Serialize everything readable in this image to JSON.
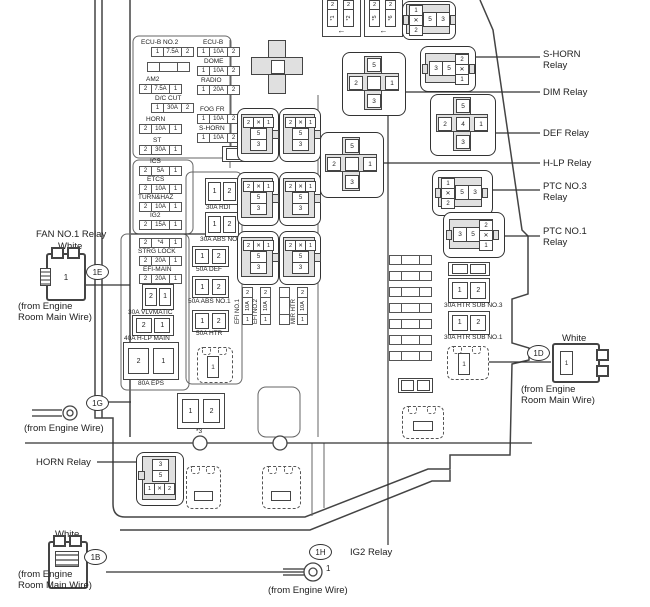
{
  "t": {
    "fan1": "FAN NO.1 Relay",
    "white": "White",
    "src_main": "(from Engine\nRoom Main Wire)",
    "src_wire": "(from Engine Wire)",
    "horn_relay": "HORN Relay",
    "ig2_relay": "IG2 Relay",
    "shorn": "S-HORN\nRelay",
    "dim": "DIM Relay",
    "def": "DEF Relay",
    "hlp": "H-LP Relay",
    "ptc3": "PTC NO.3\nRelay",
    "ptc1": "PTC NO.1\nRelay",
    "tag_1e": "1E",
    "tag_1g": "1G",
    "tag_1b": "1B",
    "tag_1h": "1H",
    "tag_1d": "1D",
    "one": "1",
    "arrow": "←"
  },
  "f": {
    "ecu_b_no2": {
      "l": "ECU-B NO.2",
      "c": [
        "1",
        "7.5A",
        "2"
      ]
    },
    "ecu_b": {
      "l": "ECU-B",
      "c": [
        "1",
        "10A",
        "2"
      ]
    },
    "blank_l": {
      "l": "",
      "c": [
        "",
        "",
        ""
      ]
    },
    "dome": {
      "l": "DOME",
      "c": [
        "1",
        "10A",
        "2"
      ]
    },
    "am2": {
      "l": "AM2",
      "c": [
        "2",
        "7.5A",
        "1"
      ]
    },
    "radio": {
      "l": "RADIO",
      "c": [
        "1",
        "20A",
        "2"
      ]
    },
    "dc_cut": {
      "l": "D/C CUT",
      "c": [
        "1",
        "30A",
        "2"
      ]
    },
    "fog_fr": {
      "l": "FOG FR",
      "c": [
        "1",
        "10A",
        "2"
      ]
    },
    "horn": {
      "l": "HORN",
      "c": [
        "2",
        "10A",
        "1"
      ]
    },
    "s_horn": {
      "l": "S-HORN",
      "c": [
        "1",
        "10A",
        "2"
      ]
    },
    "st": {
      "l": "ST",
      "c": [
        "2",
        "30A",
        "1"
      ]
    },
    "ics": {
      "l": "ICS",
      "c": [
        "2",
        "5A",
        "1"
      ]
    },
    "etcs": {
      "l": "ETCS",
      "c": [
        "2",
        "10A",
        "1"
      ]
    },
    "turn_haz": {
      "l": "TURN&HAZ",
      "c": [
        "2",
        "10A",
        "1"
      ]
    },
    "ig2": {
      "l": "IG2",
      "c": [
        "2",
        "15A",
        "1"
      ]
    },
    "star4": {
      "l": "",
      "c": [
        "2",
        "*4",
        "1"
      ]
    },
    "strg_lock": {
      "l": "STRG LOCK",
      "c": [
        "2",
        "20A",
        "1"
      ]
    },
    "efi_main": {
      "l": "EFI-MAIN",
      "c": [
        "2",
        "20A",
        "1"
      ]
    }
  },
  "m": {
    "vlvmatic": {
      "l": "30A VLVMATIC",
      "c": [
        "2",
        "1"
      ]
    },
    "hlp_main": {
      "l": "40A H-LP MAIN",
      "c": [
        "2",
        "1"
      ]
    },
    "eps": {
      "l": "80A EPS",
      "c": [
        "2",
        "1"
      ]
    },
    "rdi": {
      "l": "30A RDI",
      "c": [
        "1",
        "2"
      ]
    },
    "abs2": {
      "l": "30A ABS NO.2",
      "c": [
        "1",
        "2"
      ]
    },
    "def50": {
      "l": "50A DEF",
      "c": [
        "1",
        "2"
      ]
    },
    "abs1": {
      "l": "50A ABS NO.1",
      "c": [
        "1",
        "2"
      ]
    },
    "htr": {
      "l": "50A HTR",
      "c": [
        "1",
        "2"
      ]
    },
    "sub3": {
      "l": "30A HTR SUB NO.3",
      "c": [
        "1",
        "2"
      ]
    },
    "sub1": {
      "l": "30A HTR SUB NO.1",
      "c": [
        "1",
        "2"
      ]
    },
    "star3": {
      "l": "*3",
      "c": [
        "1",
        "2"
      ]
    }
  },
  "v": {
    "efi1": {
      "l": "EFI NO.1",
      "c": [
        "2",
        "10A",
        "1"
      ]
    },
    "efi2": {
      "l": "EFI NO.2",
      "c": [
        "2",
        "10A",
        "1"
      ]
    },
    "vblank": {
      "l": "",
      "c": [
        "",
        "",
        ""
      ]
    },
    "mir": {
      "l": "MIR HTR",
      "c": [
        "2",
        "10A",
        "1"
      ]
    }
  },
  "links": {
    "l1": {
      "t": "2",
      "n": "*1"
    },
    "l2": {
      "t": "2",
      "n": "*2"
    },
    "l5": {
      "t": "2",
      "n": "*5"
    },
    "l6": {
      "t": "2",
      "n": "*6"
    }
  },
  "r": {
    "top": {
      "s": [
        "1",
        "✕",
        "2"
      ],
      "p": [
        "5",
        "3"
      ]
    },
    "shorn": {
      "p": [
        "3",
        "5"
      ],
      "s": [
        "2",
        "✕",
        "1"
      ]
    },
    "ptc3": {
      "s": [
        "1",
        "✕",
        "2"
      ],
      "p": [
        "5",
        "3"
      ]
    },
    "ptc1": {
      "p": [
        "3",
        "5"
      ],
      "s": [
        "2",
        "✕",
        "1"
      ]
    },
    "dim": {
      "t": "5",
      "lf": "2",
      "c": "",
      "rt": "1",
      "b": "3"
    },
    "def": {
      "t": "5",
      "lf": "2",
      "c": "4",
      "rt": "1",
      "b": "3"
    },
    "hlp": {
      "t": "5",
      "lf": "2",
      "c": "",
      "rt": "1",
      "b": "3"
    },
    "vert": {
      "row": [
        "2",
        "✕",
        "1"
      ],
      "mid": "5",
      "bot": "3"
    },
    "horn": {
      "top": "3",
      "mid": "5",
      "row": [
        "1",
        "✕",
        "2"
      ]
    }
  },
  "d": {
    "d1": "1",
    "d2": "1"
  }
}
